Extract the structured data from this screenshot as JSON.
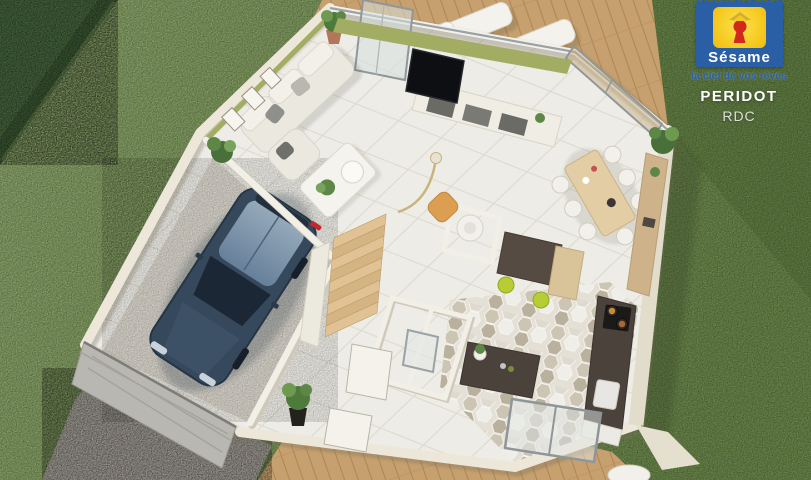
{
  "overlay": {
    "brand_top_text": "MAISONS",
    "logo": {
      "name": "Sésame",
      "tagline": "la clef de vos rêves"
    },
    "plan_title": "PERIDOT",
    "floor_label": "RDC"
  },
  "palette": {
    "logo_blue": "#2a5fa5",
    "logo_yellow": "#f5c81e",
    "logo_red": "#d3291c",
    "grass": "#85a161",
    "hedge": "#3c5833",
    "deck_wood": "#c6a06f",
    "gravel": "#a49f97",
    "wall_cream": "#ece7d9",
    "floor_tile": "#edece6",
    "accent_olive": "#a3ac63",
    "counter_dark": "#4b423c",
    "stool_lime": "#b7cd33",
    "car_navy": "#36495c"
  }
}
